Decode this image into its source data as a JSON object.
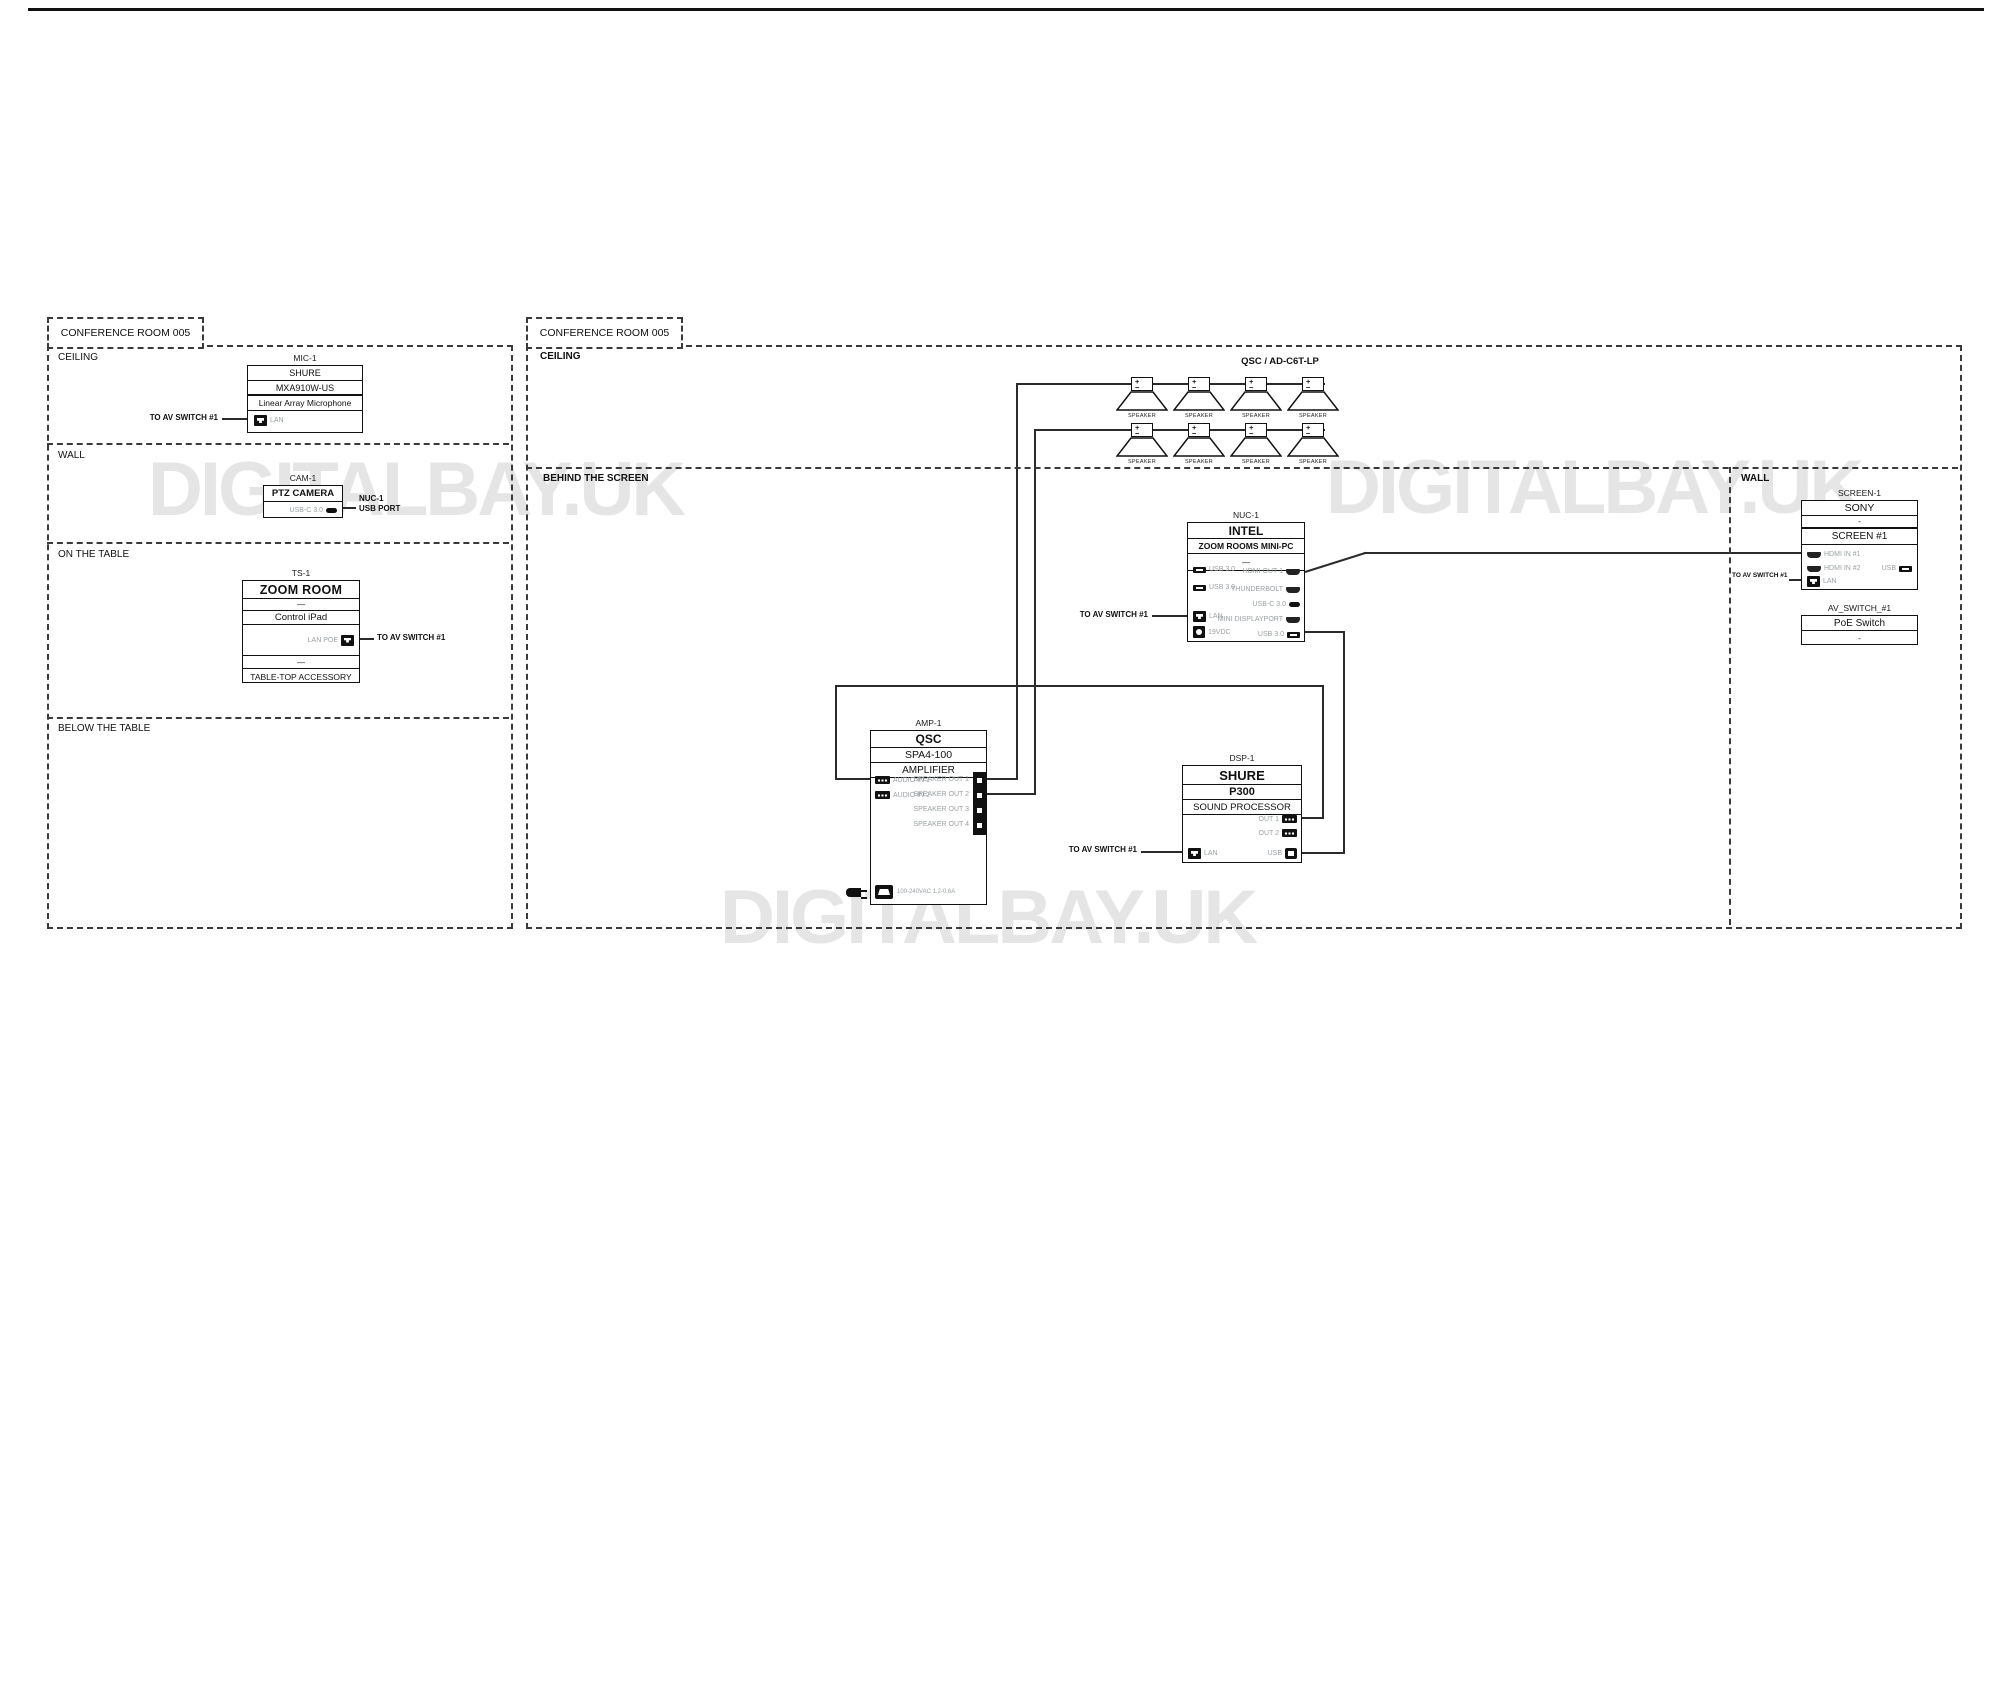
{
  "page": {
    "watermark": "DIGITALBAY.UK",
    "colors": {
      "ink": "#111111",
      "wire": "#2b2b2b",
      "port_label": "#9aa0a3",
      "watermark": "#e5e5e5"
    },
    "icons": [
      "lan-icon",
      "usb-a-icon",
      "usb-c-icon",
      "hdmi-icon",
      "power-icon",
      "phoenix-icon",
      "usb-b-icon",
      "ac-inlet-icon",
      "ac-plug-icon",
      "speaker-symbol"
    ]
  },
  "panel1": {
    "title": "CONFERENCE ROOM 005",
    "sections": {
      "ceiling": "CEILING",
      "wall": "WALL",
      "table": "ON THE TABLE",
      "below": "BELOW THE TABLE"
    },
    "mic": {
      "id": "MIC-1",
      "brand": "SHURE",
      "model": "MXA910W-US",
      "desc": "Linear Array Microphone",
      "port": "LAN",
      "conn": "TO AV SWITCH  #1"
    },
    "cam": {
      "id": "CAM-1",
      "name": "PTZ CAMERA",
      "port": "USB-C 3.0",
      "conn_line1": "NUC-1",
      "conn_line2": "USB PORT"
    },
    "ts": {
      "id": "TS-1",
      "brand": "ZOOM ROOM",
      "dash": "—",
      "desc": "Control iPad",
      "port": "LAN POE",
      "dash2": "—",
      "footer": "TABLE-TOP ACCESSORY",
      "conn": "TO AV SWITCH #1"
    }
  },
  "panel2": {
    "title": "CONFERENCE ROOM 005",
    "sections": {
      "ceiling": "CEILING",
      "behind": "BEHIND THE SCREEN",
      "wall": "WALL"
    },
    "speakers": {
      "title": "QSC / AD-C6T-LP",
      "label": "SPEAKER",
      "plus": "+",
      "minus": "−"
    },
    "nuc": {
      "id": "NUC-1",
      "brand": "INTEL",
      "model": "ZOOM ROOMS MINI-PC",
      "dash": "—",
      "ports_left": [
        "USB 3.0",
        "USB 3.0",
        "LAN",
        "19VDC"
      ],
      "ports_right": [
        "HDMI OUT 1",
        "THUNDERBOLT",
        "USB-C 3.0",
        "MINI DISPLAYPORT",
        "USB 3.0"
      ],
      "conn": "TO AV SWITCH #1"
    },
    "amp": {
      "id": "AMP-1",
      "brand": "QSC",
      "model": "SPA4-100",
      "desc": "AMPLIFIER",
      "ports_left": [
        "AUDIO IN 1",
        "AUDIO IN 2"
      ],
      "ports_right": [
        "SPEAKER OUT 1",
        "SPEAKER OUT 2",
        "SPEAKER OUT 3",
        "SPEAKER OUT 4"
      ],
      "power": "100-240VAC 1.2-0.6A"
    },
    "dsp": {
      "id": "DSP-1",
      "brand": "SHURE",
      "model": "P300",
      "desc": "SOUND PROCESSOR",
      "out1": "OUT 1",
      "out2": "OUT 2",
      "lan": "LAN",
      "usb": "USB",
      "conn": "TO AV SWITCH #1"
    },
    "screen": {
      "id": "SCREEN-1",
      "brand": "SONY",
      "dash": "-",
      "name": "SCREEN #1",
      "hdmi1": "HDMI IN #1",
      "hdmi2": "HDMI IN #2",
      "lan": "LAN",
      "usb": "USB",
      "conn": "TO AV SWITCH #1"
    },
    "poe": {
      "id": "AV_SWITCH_#1",
      "name": "PoE Switch",
      "dash": "-"
    }
  }
}
